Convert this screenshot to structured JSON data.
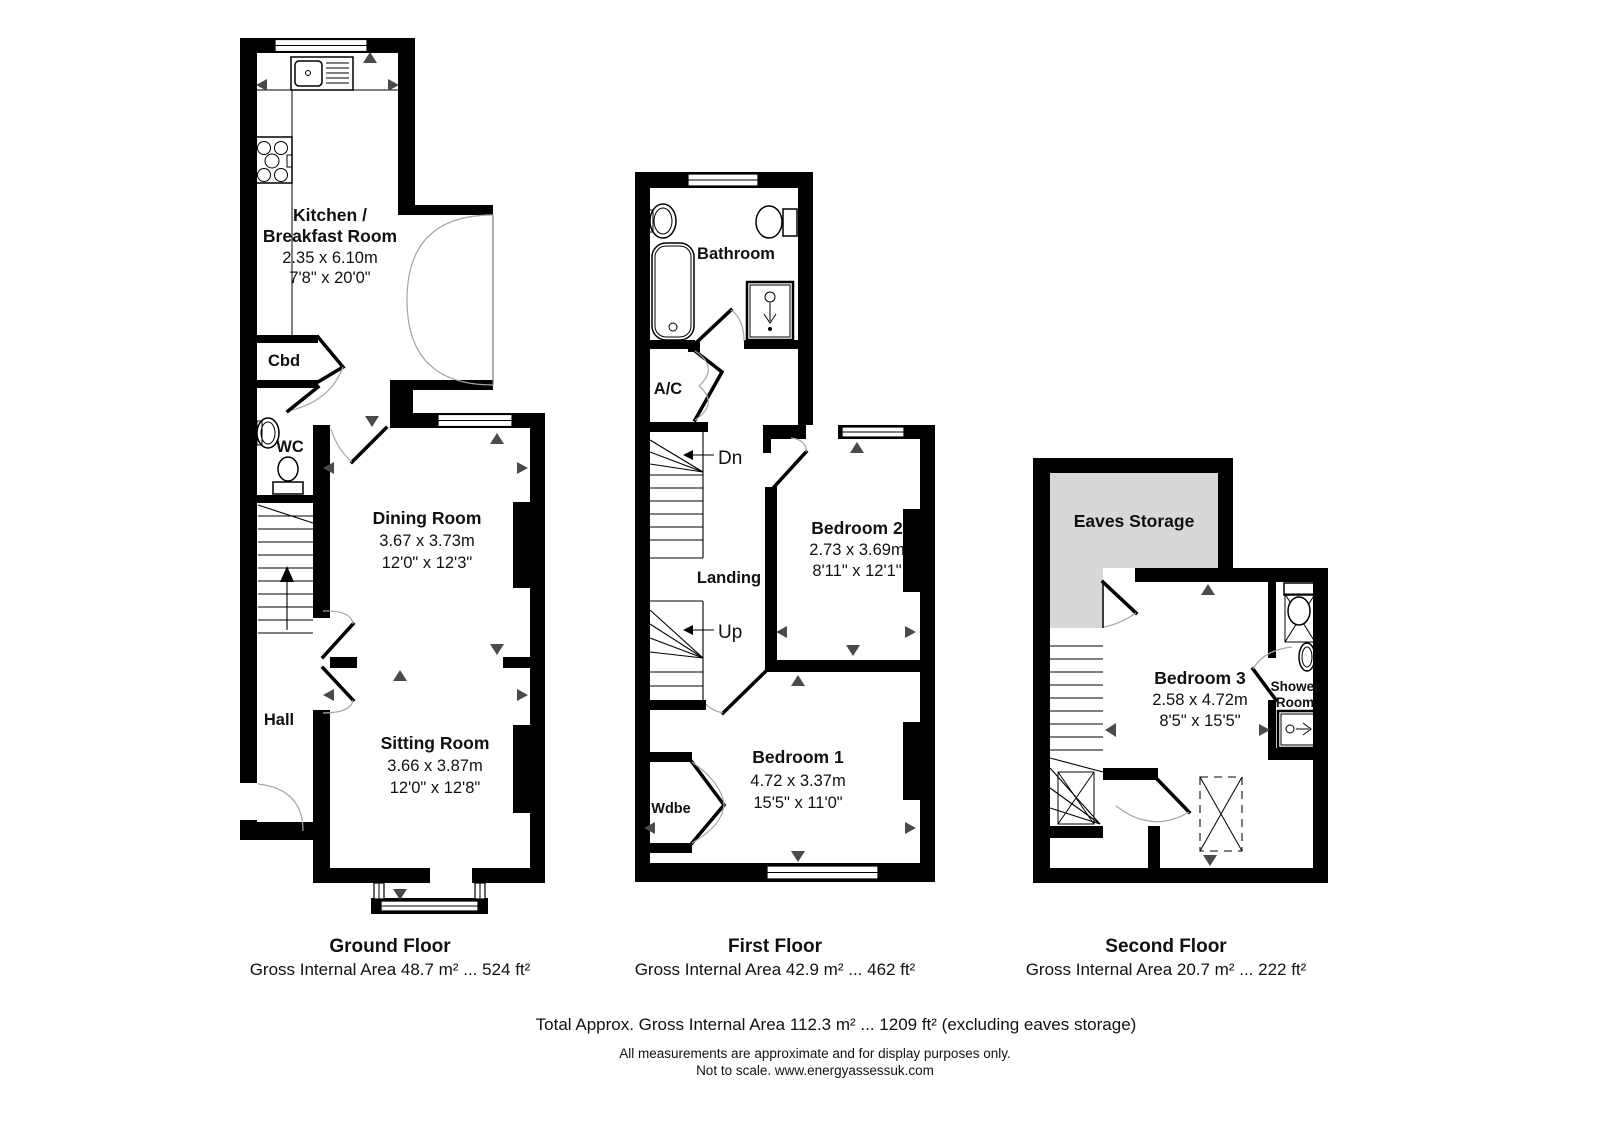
{
  "floors": {
    "ground": {
      "title": "Ground Floor",
      "area": "Gross Internal Area 48.7 m² ... 524 ft²",
      "rooms": {
        "kitchen": {
          "line1": "Kitchen /",
          "line2": "Breakfast Room",
          "dims_m": "2.35 x 6.10m",
          "dims_ft": "7'8\" x 20'0\""
        },
        "cbd": {
          "label": "Cbd"
        },
        "wc": {
          "label": "WC"
        },
        "dining": {
          "name": "Dining Room",
          "dims_m": "3.67 x 3.73m",
          "dims_ft": "12'0\" x 12'3\""
        },
        "hall": {
          "label": "Hall"
        },
        "sitting": {
          "name": "Sitting Room",
          "dims_m": "3.66 x 3.87m",
          "dims_ft": "12'0\" x 12'8\""
        }
      }
    },
    "first": {
      "title": "First Floor",
      "area": "Gross Internal Area 42.9 m² ... 462 ft²",
      "rooms": {
        "bathroom": {
          "label": "Bathroom"
        },
        "ac": {
          "label": "A/C"
        },
        "dn": {
          "label": "Dn"
        },
        "landing": {
          "label": "Landing"
        },
        "up": {
          "label": "Up"
        },
        "bedroom2": {
          "name": "Bedroom 2",
          "dims_m": "2.73 x 3.69m",
          "dims_ft": "8'11\" x 12'1\""
        },
        "bedroom1": {
          "name": "Bedroom 1",
          "dims_m": "4.72 x 3.37m",
          "dims_ft": "15'5\" x 11'0\""
        },
        "wdbe": {
          "label": "Wdbe"
        }
      }
    },
    "second": {
      "title": "Second Floor",
      "area": "Gross Internal Area 20.7 m² ... 222 ft²",
      "rooms": {
        "eaves": {
          "label": "Eaves Storage"
        },
        "bedroom3": {
          "name": "Bedroom 3",
          "dims_m": "2.58 x 4.72m",
          "dims_ft": "8'5\" x 15'5\""
        },
        "shower": {
          "line1": "Shower",
          "line2": "Room"
        }
      }
    }
  },
  "footer": {
    "total": "Total Approx. Gross Internal Area 112.3 m² ... 1209 ft² (excluding eaves storage)",
    "disclaimer": "All measurements are approximate and for display purposes only.",
    "scale_note": "Not to scale. www.energyassessuk.com"
  },
  "colors": {
    "wall": "#000000",
    "eaves_fill": "#d8d8d8",
    "arrow": "#4a4a4a",
    "door_arc": "#a6a6a6"
  }
}
